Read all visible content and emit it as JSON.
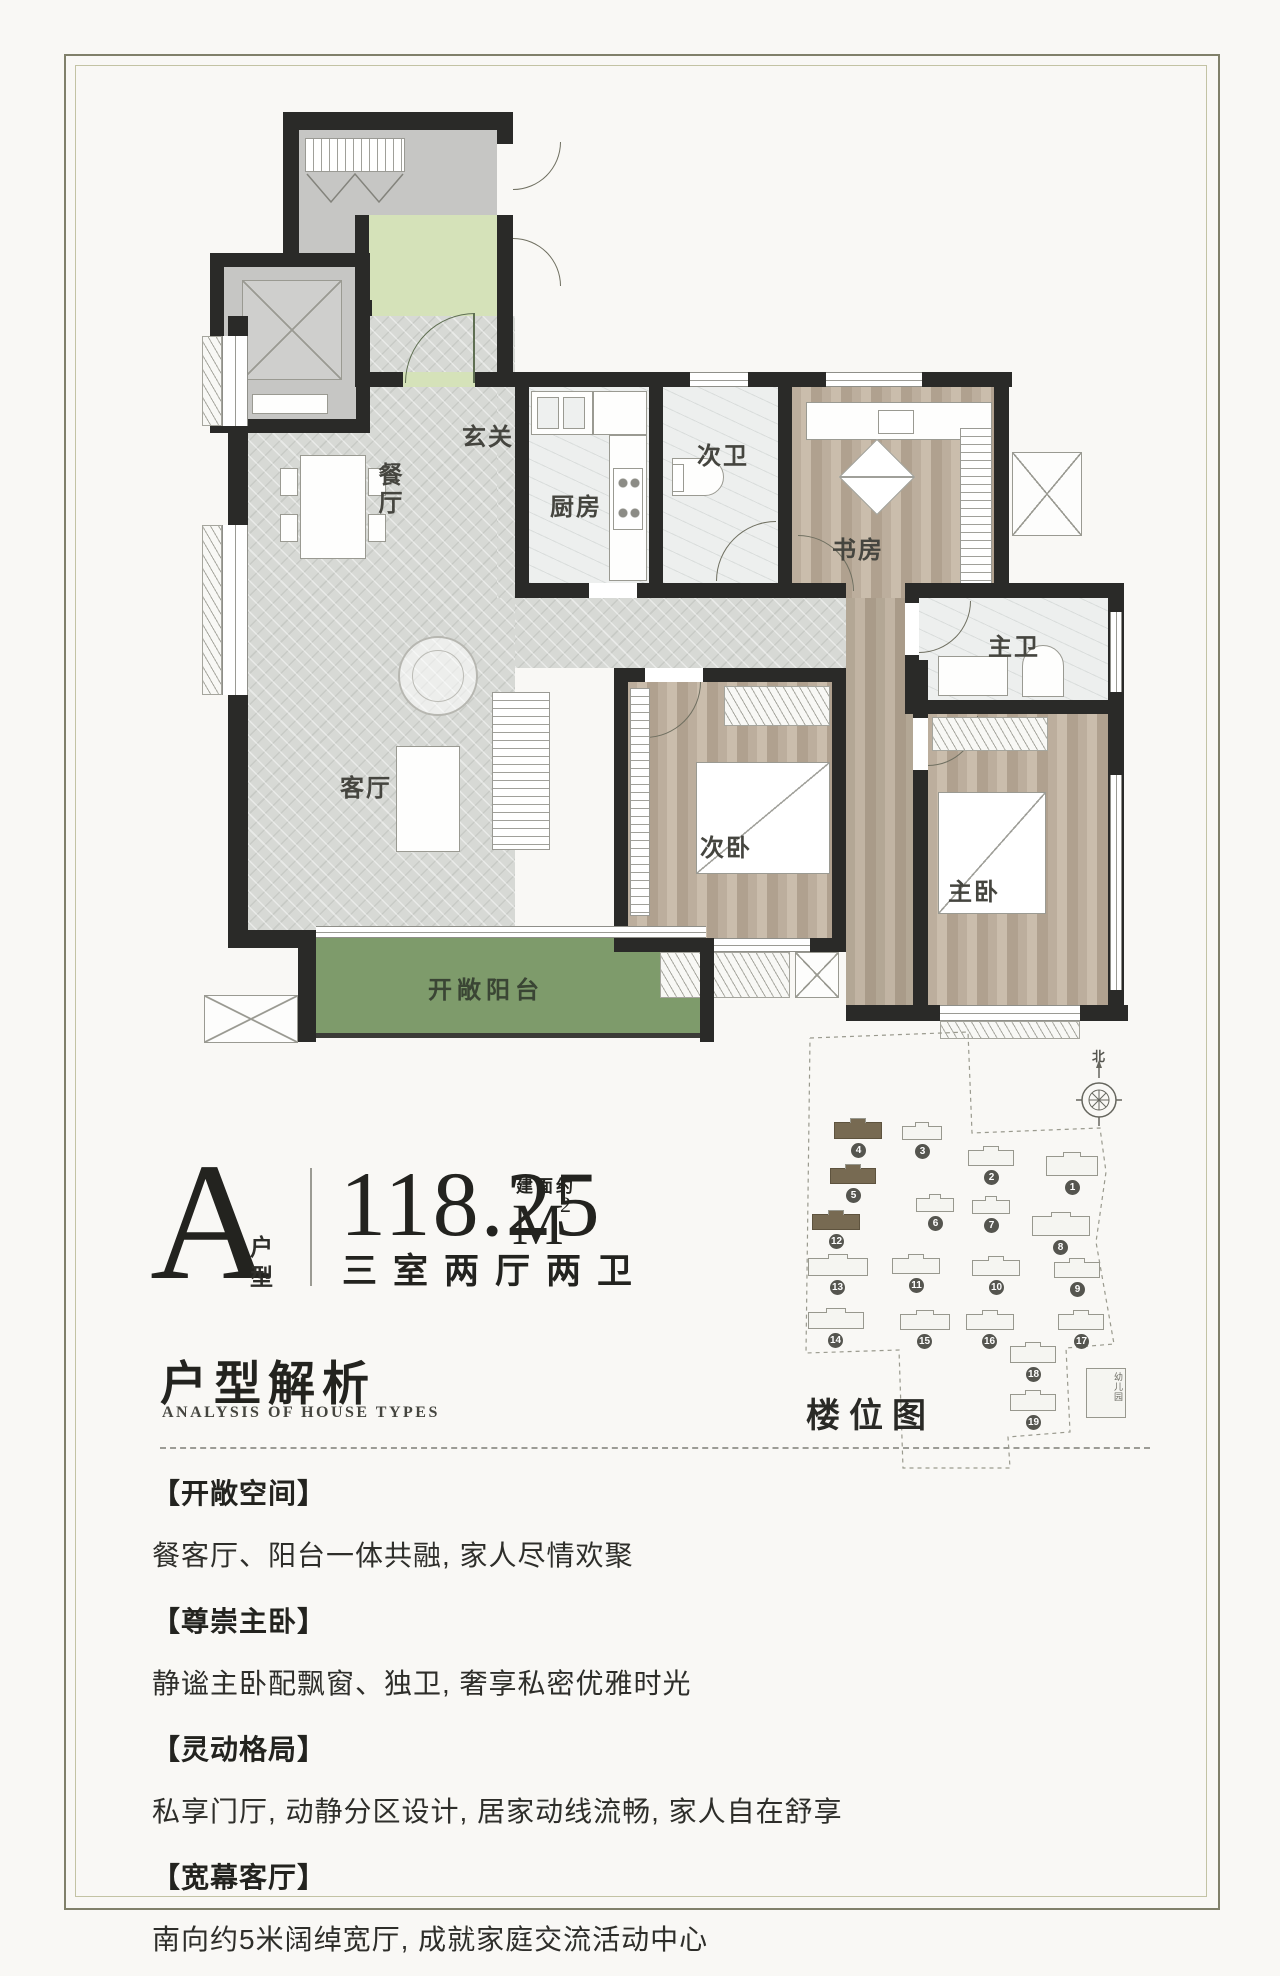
{
  "unit_info": {
    "type_letter": "A",
    "type_label_1": "户",
    "type_label_2": "型",
    "area_value": "118.25",
    "area_unit": "M",
    "area_superscript": "2",
    "area_prefix": "建面约",
    "rooms_summary": "三室两厅两卫"
  },
  "analysis": {
    "title_cn": "户型解析",
    "title_en": "ANALYSIS OF HOUSE TYPES"
  },
  "floor_plan": {
    "rooms": {
      "foyer": "玄关",
      "dining": "餐厅",
      "kitchen": "厨房",
      "second_bath": "次卫",
      "study": "书房",
      "master_bath": "主卫",
      "living": "客厅",
      "second_bedroom": "次卧",
      "master_bedroom": "主卧",
      "balcony": "开敞阳台"
    }
  },
  "site_plan": {
    "label": "楼位图",
    "north_label": "北",
    "kindergarten_label": "幼儿园",
    "building_numbers": [
      "1",
      "2",
      "3",
      "4",
      "5",
      "6",
      "7",
      "8",
      "9",
      "10",
      "11",
      "12",
      "13",
      "14",
      "15",
      "16",
      "17",
      "18",
      "19"
    ],
    "highlighted_buildings": [
      "4",
      "5",
      "12"
    ]
  },
  "features": [
    {
      "heading": "【开敞空间】",
      "body": "餐客厅、阳台一体共融, 家人尽情欢聚"
    },
    {
      "heading": "【尊崇主卧】",
      "body": "静谧主卧配飘窗、独卫, 奢享私密优雅时光"
    },
    {
      "heading": "【灵动格局】",
      "body": "私享门厅, 动静分区设计, 居家动线流畅, 家人自在舒享"
    },
    {
      "heading": "【宽幕客厅】",
      "body": "南向约5米阔绰宽厅, 成就家庭交流活动中心"
    }
  ],
  "colors": {
    "wall": "#2a2a28",
    "balcony_green": "#7e9b6b",
    "vestibule_green": "#d5e2b9",
    "highlight_building": "#776a52"
  }
}
